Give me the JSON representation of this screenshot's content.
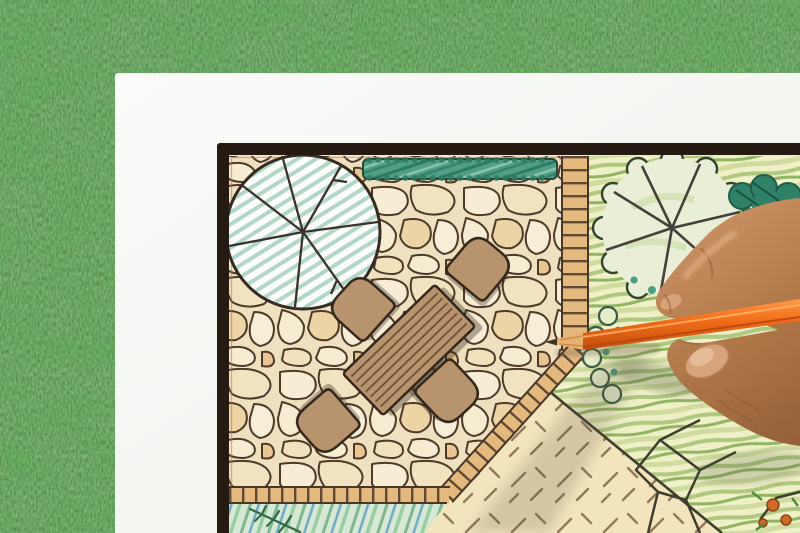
{
  "scene": {
    "description": "Photograph of a hand drawing a garden landscape architecture plan with an orange colored pencil; the white plan sheet lies on green grass",
    "background_label": "grass backdrop",
    "paper_label": "white paper sheet",
    "plan_label": "garden plan drawing",
    "hand_label": "hand holding pencil",
    "pencil_label": "orange colored pencil",
    "plan": {
      "patio_label": "flagstone patio",
      "hedge_label": "hedge strip",
      "edging_label": "brick edging band",
      "tree_large_label": "tree symbol with radial branches",
      "tree_lawn_label": "scalloped lawn tree symbol",
      "shrub_label": "teal shrub mass",
      "table_label": "patio table",
      "table_plank_count": 7,
      "chair_label": "patio chair",
      "chair_count": 4,
      "lawn_label": "lawn area",
      "groundcover_label": "groundcover bed with hatch marks",
      "bed_label": "planting bed",
      "rock_path_label": "rock path outline",
      "corner_planting_label": "corner planting detail"
    }
  },
  "palette": {
    "grass_base": "#48713c",
    "paper": "#fafbf8",
    "frame": "#261b12",
    "stone_fill": "#f6ecd2",
    "stone_line": "#4e3a2a",
    "brick": "#e4b97e",
    "brick_line": "#4a3629",
    "hedge": "#4f9e85",
    "lawn_base": "#eff0c8",
    "furniture_wood": "#b8946e",
    "plank_line": "#6e5137",
    "groundcover": "#f2e4bc",
    "bed": "#d7e8d5",
    "tree_hatch": "#b2d6c8",
    "skin": "#b5784e",
    "pencil_orange": "#f06a16",
    "pencil_wood": "#e9b271",
    "pencil_lead": "#3f3226",
    "shadow": "#5f5443"
  }
}
